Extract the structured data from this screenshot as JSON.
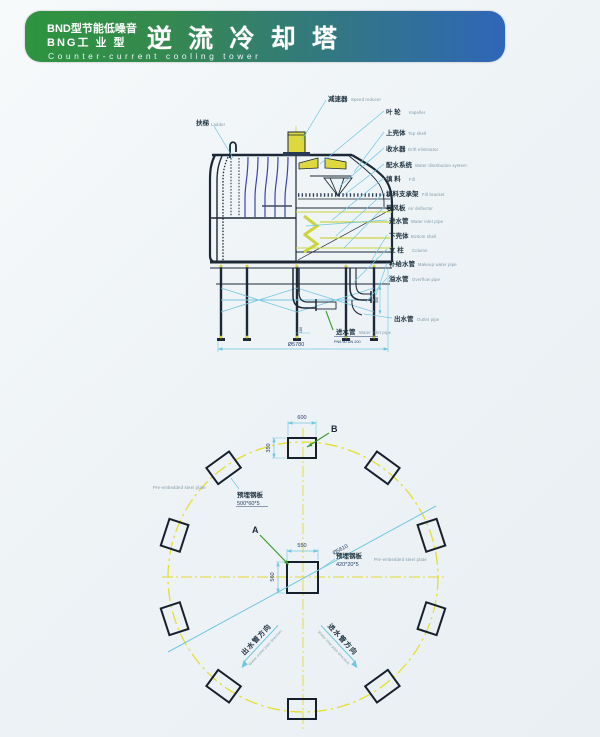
{
  "header": {
    "model_line1": "BND型节能低噪音",
    "model_line2": "BNG工 业 型",
    "title": "逆 流 冷 却 塔",
    "subtitle": "Counter-current cooling tower",
    "colors": {
      "gradient_left": "#2e9440",
      "gradient_right": "#2f66b8",
      "text": "#ffffff"
    }
  },
  "section": {
    "ladder": {
      "zh": "扶梯",
      "en": "Ladder"
    },
    "labels": [
      {
        "zh": "减速器",
        "en": "Speed reducer"
      },
      {
        "zh": "叶 轮",
        "en": "Impeller"
      },
      {
        "zh": "上壳体",
        "en": "Top shell"
      },
      {
        "zh": "收水器",
        "en": "Drift eliminator"
      },
      {
        "zh": "配水系统",
        "en": "Water distribution system"
      },
      {
        "zh": "填 料",
        "en": "Fill"
      },
      {
        "zh": "填料支承架",
        "en": "Fill bracket"
      },
      {
        "zh": "导风板",
        "en": "Air deflector"
      },
      {
        "zh": "进水管",
        "en": "Water inlet pipe"
      },
      {
        "zh": "下壳体",
        "en": "Bottom shell"
      },
      {
        "zh": "立 柱",
        "en": "Column"
      },
      {
        "zh": "补给水管",
        "en": "Makeup water pipe"
      },
      {
        "zh": "溢水管",
        "en": "Overflow pipe"
      },
      {
        "zh": "出水管",
        "en": "Outlet pipe"
      }
    ],
    "inlet_bottom": {
      "zh": "进水管",
      "en": "Water inlet pipe",
      "spec": "PN6 60 DN 200"
    },
    "dims": {
      "overall": "Ø5780",
      "outlet_riser": "350",
      "inlet_offset": "160"
    }
  },
  "plan": {
    "marker_a": "A",
    "marker_b": "B",
    "dims": {
      "b_width": "600",
      "b_height": "350",
      "a_width": "550",
      "a_height": "560",
      "bolt_circle": "Ø5610"
    },
    "outer_plate": {
      "zh": "预埋钢板",
      "size": "500*60*5",
      "en": "Pre-embedded steel plate"
    },
    "center_plate": {
      "zh": "预埋钢板",
      "size": "420*20*5",
      "en": "Pre-embedded steel plate"
    },
    "outlet_dir": {
      "zh": "出水管方向",
      "en": "Water outlet pipe direction"
    },
    "inlet_dir": {
      "zh": "进水管方向",
      "en": "Water inlet pipe direction"
    }
  },
  "colors": {
    "line_dark": "#1c2836",
    "leader_cyan": "#6ec7e2",
    "pipe_blue": "#3946ae",
    "accent_yellow": "#d8d23a",
    "fill_green": "#cdd53e",
    "circle_yellow": "#e6de2e",
    "marker_green": "#3f9a2f"
  }
}
